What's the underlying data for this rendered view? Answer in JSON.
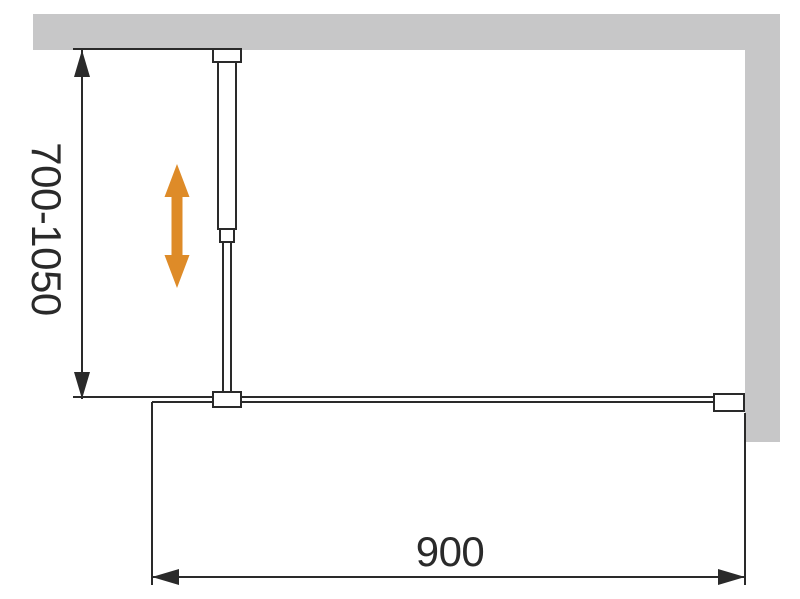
{
  "diagram": {
    "type": "installation-dimension-diagram",
    "dimensions": {
      "height_range_label": "700-1050",
      "width_label": "900"
    },
    "colors": {
      "wall": "#c7c7c8",
      "line": "#2a2a2a",
      "arrow": "#de8b28",
      "background": "#ffffff"
    }
  }
}
